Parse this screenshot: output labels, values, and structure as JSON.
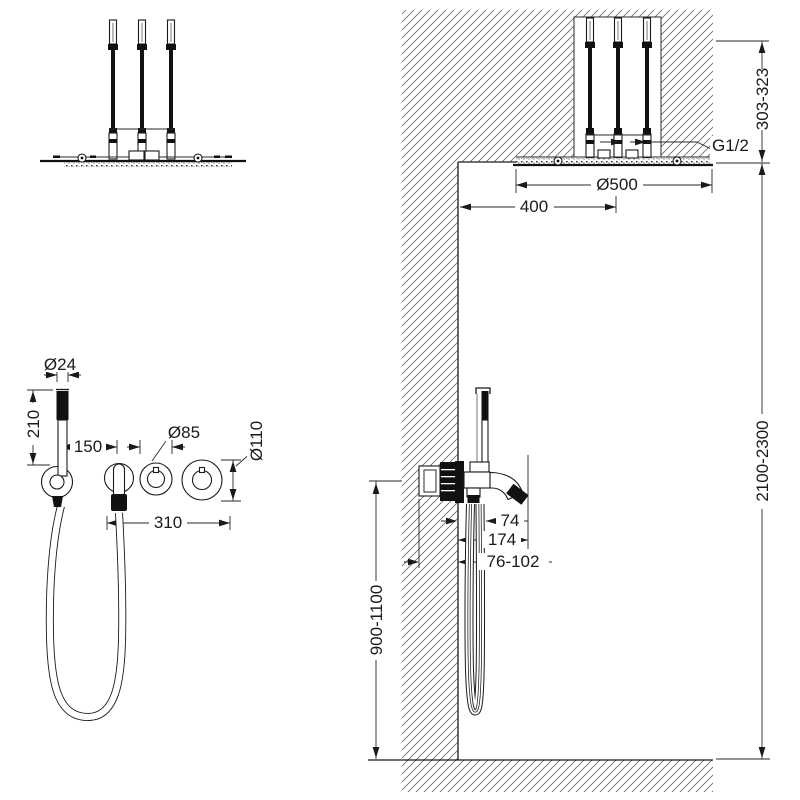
{
  "meta": {
    "drawing_type": "shower system installation dimension drawing",
    "views": [
      "overhead shower front view",
      "ceiling section side view",
      "wall mixer front view",
      "wall mixer side section"
    ]
  },
  "colors": {
    "paper": "#ffffff",
    "ink": "#1a1a1a",
    "hatch": "#6f6f6f"
  },
  "dims": {
    "hand_shower_diameter": "Ø24",
    "hand_shower_length": "210",
    "hand_shower_offset": "150",
    "trim_diameter": "Ø85",
    "handle_trim_diameter": "Ø110",
    "trim_span": "310",
    "head_diameter": "Ø500",
    "head_offset": "400",
    "thread": "G1/2",
    "ceiling_depth": "303-323",
    "head_height": "2100-2300",
    "mixer_height": "900-1100",
    "spout_offset": "74",
    "spout_reach": "174",
    "embed_depth": "76-102"
  }
}
